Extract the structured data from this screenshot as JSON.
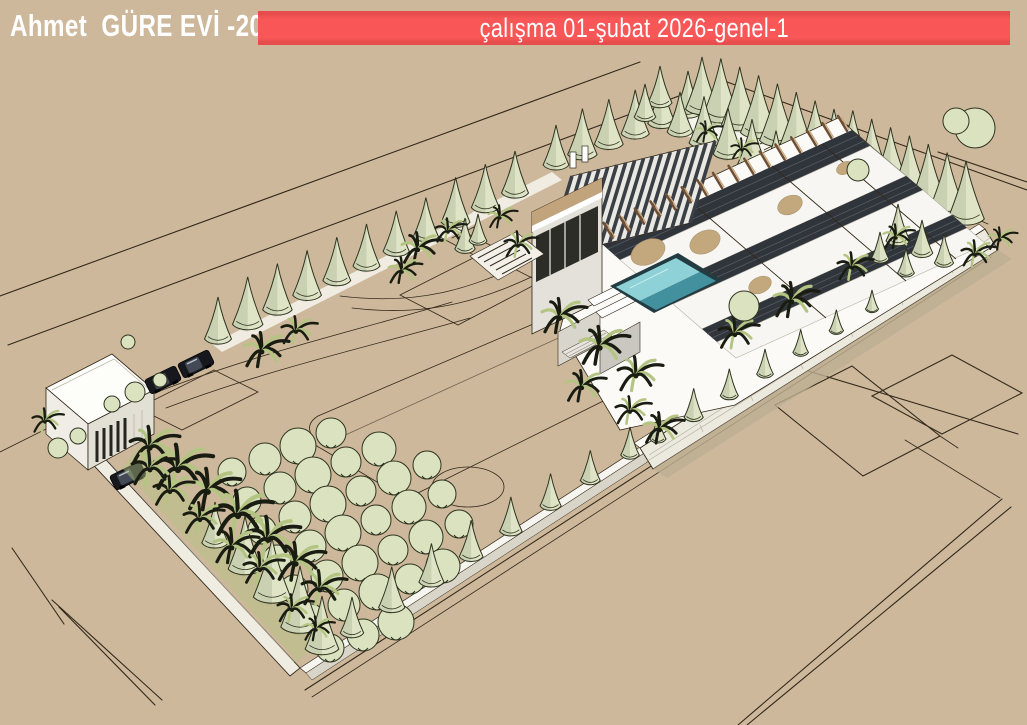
{
  "header": {
    "project_title": "Ahmet  GÜRE EVİ -2026",
    "banner_label": "çalışma 01-şubat 2026-genel-1"
  },
  "scene": {
    "description": "SketchUp-style 3D aerial rendering of a walled residential estate: modern flat-roofed house with pergola roofs and pool, cypress tree perimeter, fruit orchard, palm clusters, guard house and parked cars on tan ground with surveyed plot lines",
    "palette": {
      "bg": "#cdb89b",
      "red": "#f95757",
      "redd": "#e64c4c",
      "white": "#ffffff",
      "ink": "#34291b",
      "cypress": "#dfe4c6",
      "cypress_dark": "#2f3420",
      "orchard_green": "#dbe2c0",
      "palm_dark": "#191c10",
      "palm_light": "#b4c482",
      "path": "#f6f4ed",
      "wallw": "#efece2",
      "slat": "#30343b",
      "wood": "#6f4e36",
      "wood_light": "#c9a87c",
      "sand": "#c3a87e",
      "pool_light": "#8ed2d8",
      "pool_deep": "#43909f",
      "shadow": "#bdae92"
    },
    "cypress_rows": [
      {
        "name": "nw-row",
        "from": [
          218,
          342
        ],
        "to": [
          515,
          196
        ],
        "count": 11,
        "h_start": 48,
        "h_end": 44
      },
      {
        "name": "nw-upper-row",
        "from": [
          556,
          168
        ],
        "to": [
          688,
          116
        ],
        "count": 6,
        "h_start": 46,
        "h_end": 46
      },
      {
        "name": "ne-outer-row",
        "from": [
          702,
          112
        ],
        "to": [
          966,
          222
        ],
        "count": 15,
        "h_start": 58,
        "h_end": 64
      },
      {
        "name": "ne-inner-row",
        "from": [
          680,
          135
        ],
        "to": [
          920,
          245
        ],
        "count": 11,
        "h_start": 46,
        "h_end": 52
      },
      {
        "name": "se-lower-row",
        "from": [
          352,
          636
        ],
        "to": [
          630,
          458
        ],
        "count": 8,
        "h_start": 42,
        "h_end": 34
      },
      {
        "name": "terrace-row",
        "from": [
          658,
          442
        ],
        "to": [
          872,
          312
        ],
        "count": 7,
        "h_start": 30,
        "h_end": 24
      }
    ],
    "cypress_singles": [
      [
        898,
        244,
        40
      ],
      [
        922,
        256,
        36
      ],
      [
        944,
        266,
        32
      ],
      [
        880,
        262,
        30
      ],
      [
        906,
        276,
        28
      ],
      [
        245,
        572,
        56
      ],
      [
        272,
        600,
        62
      ],
      [
        300,
        630,
        64
      ],
      [
        322,
        652,
        56
      ],
      [
        215,
        546,
        44
      ],
      [
        465,
        252,
        34
      ],
      [
        478,
        244,
        30
      ],
      [
        660,
        106,
        40
      ],
      [
        645,
        120,
        36
      ]
    ],
    "orchard": {
      "step": [
        33,
        -13
      ],
      "radius": 16,
      "rows": [
        {
          "start": [
            232,
            472
          ],
          "count": 4
        },
        {
          "start": [
            247,
            501
          ],
          "count": 5
        },
        {
          "start": [
            262,
            530
          ],
          "count": 6
        },
        {
          "start": [
            277,
            559
          ],
          "count": 6
        },
        {
          "start": [
            294,
            589
          ],
          "count": 6
        },
        {
          "start": [
            311,
            618
          ],
          "count": 5
        },
        {
          "start": [
            330,
            648
          ],
          "count": 3
        }
      ]
    },
    "palms": [
      [
        262,
        352,
        20,
        0
      ],
      [
        296,
        332,
        16,
        1
      ],
      [
        418,
        250,
        18,
        0
      ],
      [
        448,
        232,
        14,
        1
      ],
      [
        402,
        272,
        15,
        0
      ],
      [
        500,
        218,
        13,
        0
      ],
      [
        518,
        246,
        15,
        1
      ],
      [
        560,
        318,
        20,
        0
      ],
      [
        600,
        348,
        22,
        0
      ],
      [
        636,
        376,
        20,
        1
      ],
      [
        582,
        388,
        18,
        0
      ],
      [
        630,
        412,
        16,
        1
      ],
      [
        660,
        430,
        18,
        0
      ],
      [
        735,
        335,
        18,
        1
      ],
      [
        792,
        302,
        20,
        0
      ],
      [
        852,
        268,
        16,
        1
      ],
      [
        896,
        238,
        14,
        0
      ],
      [
        975,
        255,
        15,
        1
      ],
      [
        1000,
        240,
        13,
        0
      ],
      [
        150,
        448,
        22,
        1
      ],
      [
        178,
        470,
        26,
        1
      ],
      [
        208,
        492,
        24,
        0
      ],
      [
        238,
        516,
        26,
        1
      ],
      [
        268,
        540,
        24,
        1
      ],
      [
        296,
        564,
        22,
        0
      ],
      [
        320,
        590,
        20,
        1
      ],
      [
        200,
        520,
        18,
        1
      ],
      [
        232,
        548,
        20,
        0
      ],
      [
        170,
        492,
        18,
        1
      ],
      [
        260,
        570,
        18,
        1
      ],
      [
        292,
        610,
        16,
        1
      ],
      [
        316,
        630,
        14,
        0
      ],
      [
        150,
        470,
        20,
        1
      ],
      [
        45,
        422,
        14,
        1
      ],
      [
        706,
        133,
        12,
        0
      ],
      [
        742,
        150,
        12,
        1
      ]
    ],
    "bushes": [
      [
        135,
        392,
        10
      ],
      [
        112,
        404,
        8
      ],
      [
        160,
        380,
        7
      ],
      [
        58,
        448,
        10
      ],
      [
        78,
        436,
        8
      ],
      [
        744,
        306,
        15
      ],
      [
        858,
        170,
        11
      ],
      [
        975,
        128,
        20
      ],
      [
        956,
        121,
        13
      ],
      [
        128,
        342,
        7
      ]
    ],
    "cars": [
      [
        163,
        380,
        -26
      ],
      [
        196,
        364,
        -26
      ],
      [
        128,
        476,
        -26
      ]
    ]
  }
}
